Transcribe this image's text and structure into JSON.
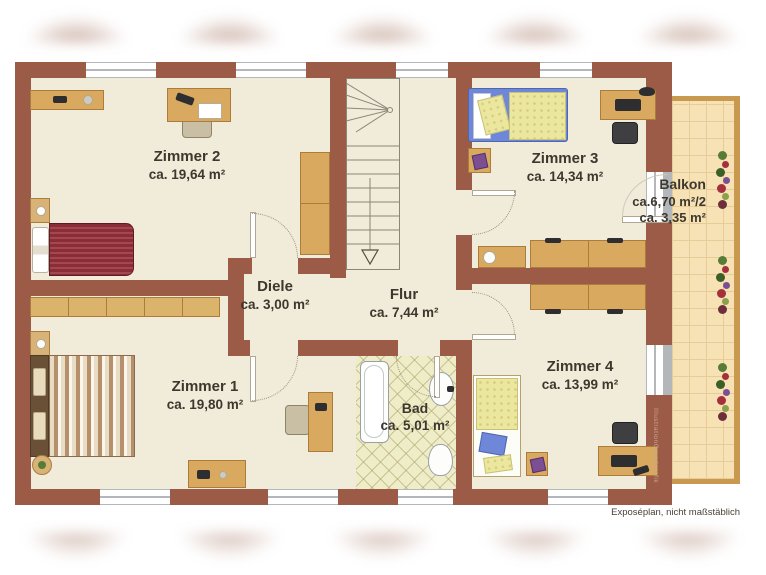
{
  "rooms": {
    "zimmer1": {
      "name": "Zimmer 1",
      "area": "ca. 19,80 m²"
    },
    "zimmer2": {
      "name": "Zimmer 2",
      "area": "ca. 19,64 m²"
    },
    "zimmer3": {
      "name": "Zimmer 3",
      "area": "ca. 14,34 m²"
    },
    "zimmer4": {
      "name": "Zimmer 4",
      "area": "ca. 13,99 m²"
    },
    "diele": {
      "name": "Diele",
      "area": "ca. 3,00 m²"
    },
    "flur": {
      "name": "Flur",
      "area": "ca. 7,44 m²"
    },
    "bad": {
      "name": "Bad",
      "area": "ca. 5,01 m²"
    },
    "balkon": {
      "name": "Balkon",
      "area_full": "ca.6,70 m²/2",
      "area_half": "ca. 3,35 m²"
    }
  },
  "footer": {
    "note": "Exposéplan, nicht maßstäblich"
  },
  "watermark": "IllustrationGrundgrafik",
  "colors": {
    "wall": "#9c5b47",
    "floor": "#f1ebd9",
    "wood": "#d9a95f",
    "balcony_tile": "#f6e2b4",
    "bath_tile": "#efedc8",
    "bed_red": "#8b2d37",
    "bed_blue": "#6e87d8",
    "bed_yellow": "#ece79e",
    "text": "#3d372e"
  }
}
